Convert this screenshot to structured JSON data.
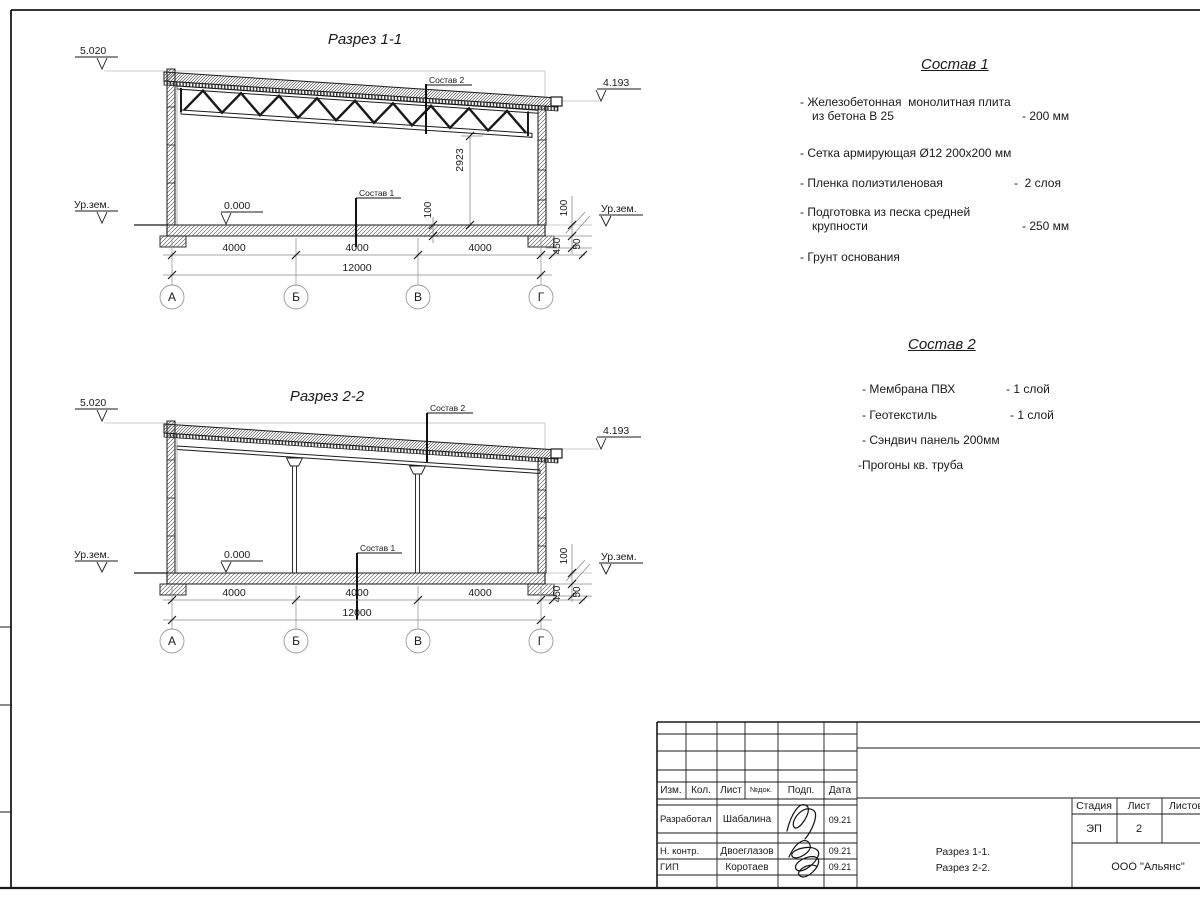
{
  "sections": {
    "s1": {
      "title": "Разрез 1-1",
      "elev_left": "5.020",
      "elev_right": "4.193",
      "zero": "0.000",
      "ground": "Ур.зем.",
      "leader_roof": "Состав 2",
      "leader_floor": "Состав 1",
      "dim_height": "2923",
      "dim_slab": "100",
      "dim_r100": "100",
      "dim_r450": "450",
      "dim_r50": "50",
      "bays": [
        "4000",
        "4000",
        "4000"
      ],
      "total": "12000",
      "axes": [
        "А",
        "Б",
        "В",
        "Г"
      ]
    },
    "s2": {
      "title": "Разрез 2-2",
      "elev_left": "5.020",
      "elev_right": "4.193",
      "zero": "0.000",
      "ground": "Ур.зем.",
      "leader_roof": "Состав 2",
      "leader_floor": "Состав 1",
      "dim_r100": "100",
      "dim_r450": "450",
      "dim_r50": "50",
      "bays": [
        "4000",
        "4000",
        "4000"
      ],
      "total": "12000",
      "axes": [
        "А",
        "Б",
        "В",
        "Г"
      ]
    }
  },
  "spec1": {
    "title": "Состав 1",
    "rows": [
      {
        "text": "- Железобетонная  монолитная плита"
      },
      {
        "text": "из бетона В 25",
        "value": "- 200 мм"
      },
      {
        "text": "- Сетка армирующая Ø12 200х200 мм"
      },
      {
        "text": "- Пленка полиэтиленовая",
        "value": "-  2 слоя"
      },
      {
        "text": "- Подготовка из песка средней"
      },
      {
        "text": "крупности",
        "value": "- 250 мм"
      },
      {
        "text": "- Грунт основания"
      }
    ]
  },
  "spec2": {
    "title": "Состав 2",
    "rows": [
      {
        "text": "- Мембрана ПВХ",
        "value": "- 1 слой"
      },
      {
        "text": "- Геотекстиль",
        "value": "- 1 слой"
      },
      {
        "text": "- Сэндвич панель 200мм"
      },
      {
        "text": "-Прогоны кв. труба"
      }
    ]
  },
  "titleblock": {
    "col_izm": "Изм.",
    "col_kol": "Кол.",
    "col_list": "Лист",
    "col_ndok": "№док.",
    "col_podp": "Подп.",
    "col_data": "Дата",
    "role_razrabotal": "Разработал",
    "name_razrabotal": "Шабалина",
    "date_razrabotal": "09.21",
    "role_nkontr": "Н. контр.",
    "name_nkontr": "Двоеглазов",
    "date_nkontr": "09.21",
    "role_gip": "ГИП",
    "name_gip": "Коротаев",
    "date_gip": "09.21",
    "stadia_label": "Стадия",
    "list_label": "Лист",
    "listov_label": "Листов",
    "stadia": "ЭП",
    "list_num": "2",
    "title_line1": "Разрез 1-1.",
    "title_line2": "Разрез 2-2.",
    "company": "ООО \"Альянс\""
  }
}
